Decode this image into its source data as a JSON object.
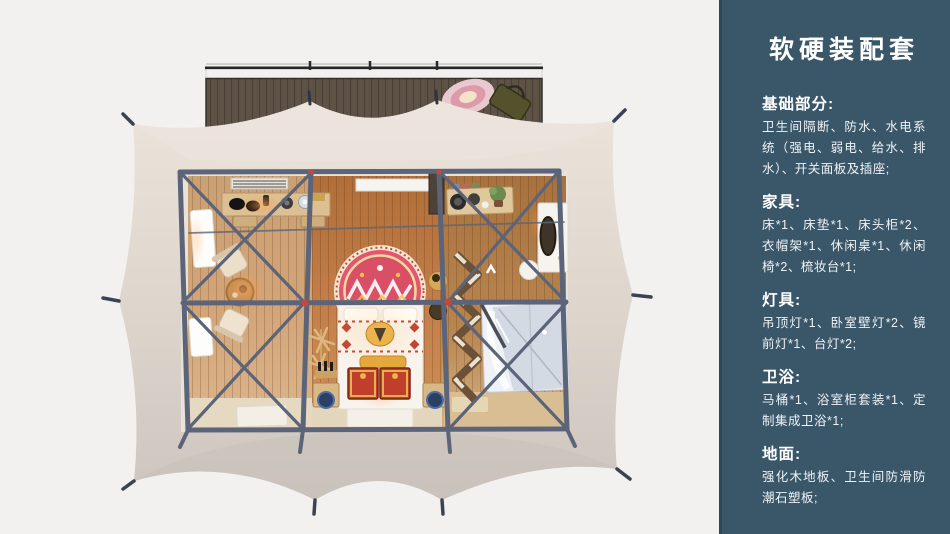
{
  "page": {
    "background": "#f2f1f0",
    "width": 950,
    "height": 534
  },
  "sidebar": {
    "background": "#3a5669",
    "edge_color": "#2e4557",
    "text_color": "#ffffff",
    "title": "软硬装配套",
    "sections": [
      {
        "id": "basics",
        "heading": "基础部分:",
        "body": "卫生间隔断、防水、水电系统（强电、弱电、给水、排水）、开关面板及插座;"
      },
      {
        "id": "furniture",
        "heading": "家具:",
        "body": "床*1、床垫*1、床头柜*2、衣帽架*1、休闲桌*1、休闲椅*2、梳妆台*1;"
      },
      {
        "id": "lighting",
        "heading": "灯具:",
        "body": "吊顶灯*1、卧室壁灯*2、镜前灯*1、台灯*2;"
      },
      {
        "id": "bathroom",
        "heading": "卫浴:",
        "body": "马桶*1、浴室柜套装*1、定制集成卫浴*1;"
      },
      {
        "id": "flooring",
        "heading": "地面:",
        "body": "强化木地板、卫生间防滑防潮石塑板;"
      }
    ]
  },
  "illustration": {
    "colors": {
      "tent_canvas": "#e6ddd4",
      "frame": "#5b6478",
      "joint": "#c8473c",
      "deck_wood": "#5d5245",
      "floor_wood": "#c17c48",
      "bed_linen": "#f7f4ee",
      "rug": "#e2566e",
      "chest": "#bf3f2c",
      "glass": "#d3dae4",
      "glow": "#ffb46a"
    }
  }
}
